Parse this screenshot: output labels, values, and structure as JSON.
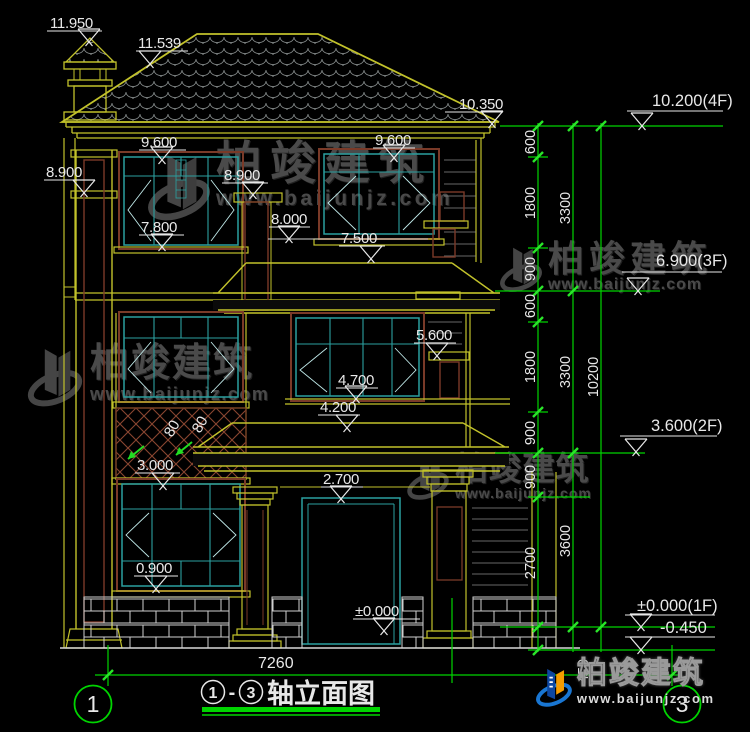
{
  "drawing": {
    "type": "elevation",
    "title_block": {
      "axis_start": "1",
      "separator": "-",
      "axis_end": "3",
      "title": "轴立面图"
    },
    "axis_bubbles": {
      "left": "1",
      "right": "3"
    }
  },
  "facade_levels": {
    "chimney_top": "11.950",
    "ridge": "11.539",
    "eave": "10.350",
    "w3_top_left": "9.600",
    "w3_top_right": "9.600",
    "band_left": "8.900",
    "band_center": "8.900",
    "ledge_8000": "8.000",
    "w3_sill_left": "7.800",
    "w3_sill_right": "7.500",
    "w2_top_right": "5.600",
    "w2_sill_right": "4.700",
    "canopy_top": "4.200",
    "lattice_sill": "3.000",
    "door_top": "2.700",
    "w1_sill": "0.900",
    "ground": "±0.000",
    "lattice_dim_a": "80",
    "lattice_dim_b": "80"
  },
  "dimensions": {
    "overall_width": "7260",
    "below_ground": "450",
    "right_chain_inner": [
      "600",
      "1800",
      "900",
      "600",
      "1800",
      "900",
      "900",
      "2700"
    ],
    "right_chain_mid": [
      "3300",
      "3300",
      "3600"
    ],
    "right_chain_outer": "10200"
  },
  "story_levels": {
    "f4": "10.200(4F)",
    "f3": "6.900(3F)",
    "f2": "3.600(2F)",
    "f1": "±0.000(1F)",
    "basement": "-0.450"
  },
  "watermark": {
    "brand": "柏竣建筑",
    "url": "www.baijunjz.com"
  },
  "colors": {
    "cad_yellow": "#c2c22b",
    "cad_green": "#00d400",
    "window_teal": "#2ba0a0",
    "frame_brown": "#7a3a28",
    "tile_gray": "#8a9090",
    "text_white": "#e8e8e8",
    "watermark_gray": "#4a4a4a",
    "logo_blue": "#1976d2",
    "logo_orange": "#f59c00"
  }
}
